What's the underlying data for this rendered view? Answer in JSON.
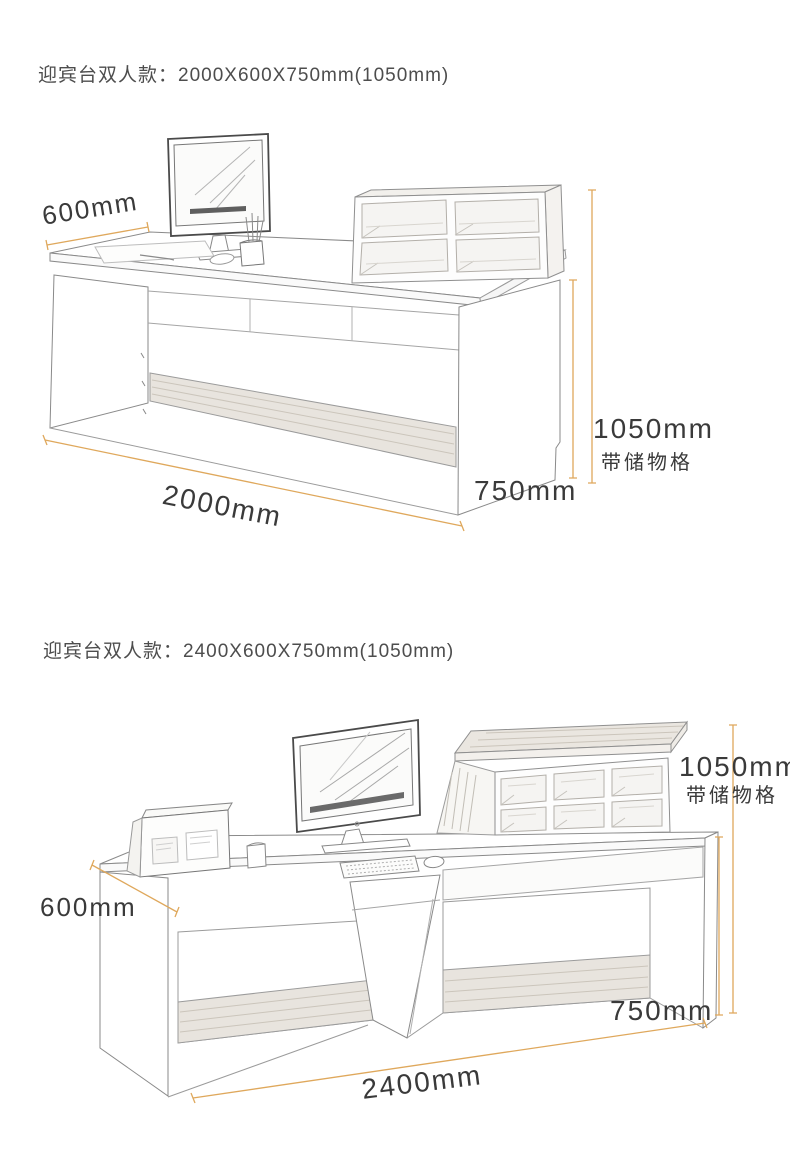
{
  "page": {
    "background": "#ffffff"
  },
  "colors": {
    "dimension_line": "#dfa85c",
    "label_text": "#3a3a3a",
    "title_text": "#4d4d4d",
    "sketch_line": "#9b9b9b",
    "wood_grain_fill": "#e8e4de"
  },
  "sections": [
    {
      "title": "迎宾台双人款：2000X600X750mm(1050mm)",
      "labels": {
        "depth": "600mm",
        "width": "2000mm",
        "desk_height": "750mm",
        "overall_height": "1050mm",
        "storage_note": "带储物格"
      }
    },
    {
      "title": "迎宾台双人款：2400X600X750mm(1050mm)",
      "labels": {
        "depth": "600mm",
        "width": "2400mm",
        "desk_height": "750mm",
        "overall_height": "1050mm",
        "storage_note": "带储物格"
      }
    }
  ]
}
